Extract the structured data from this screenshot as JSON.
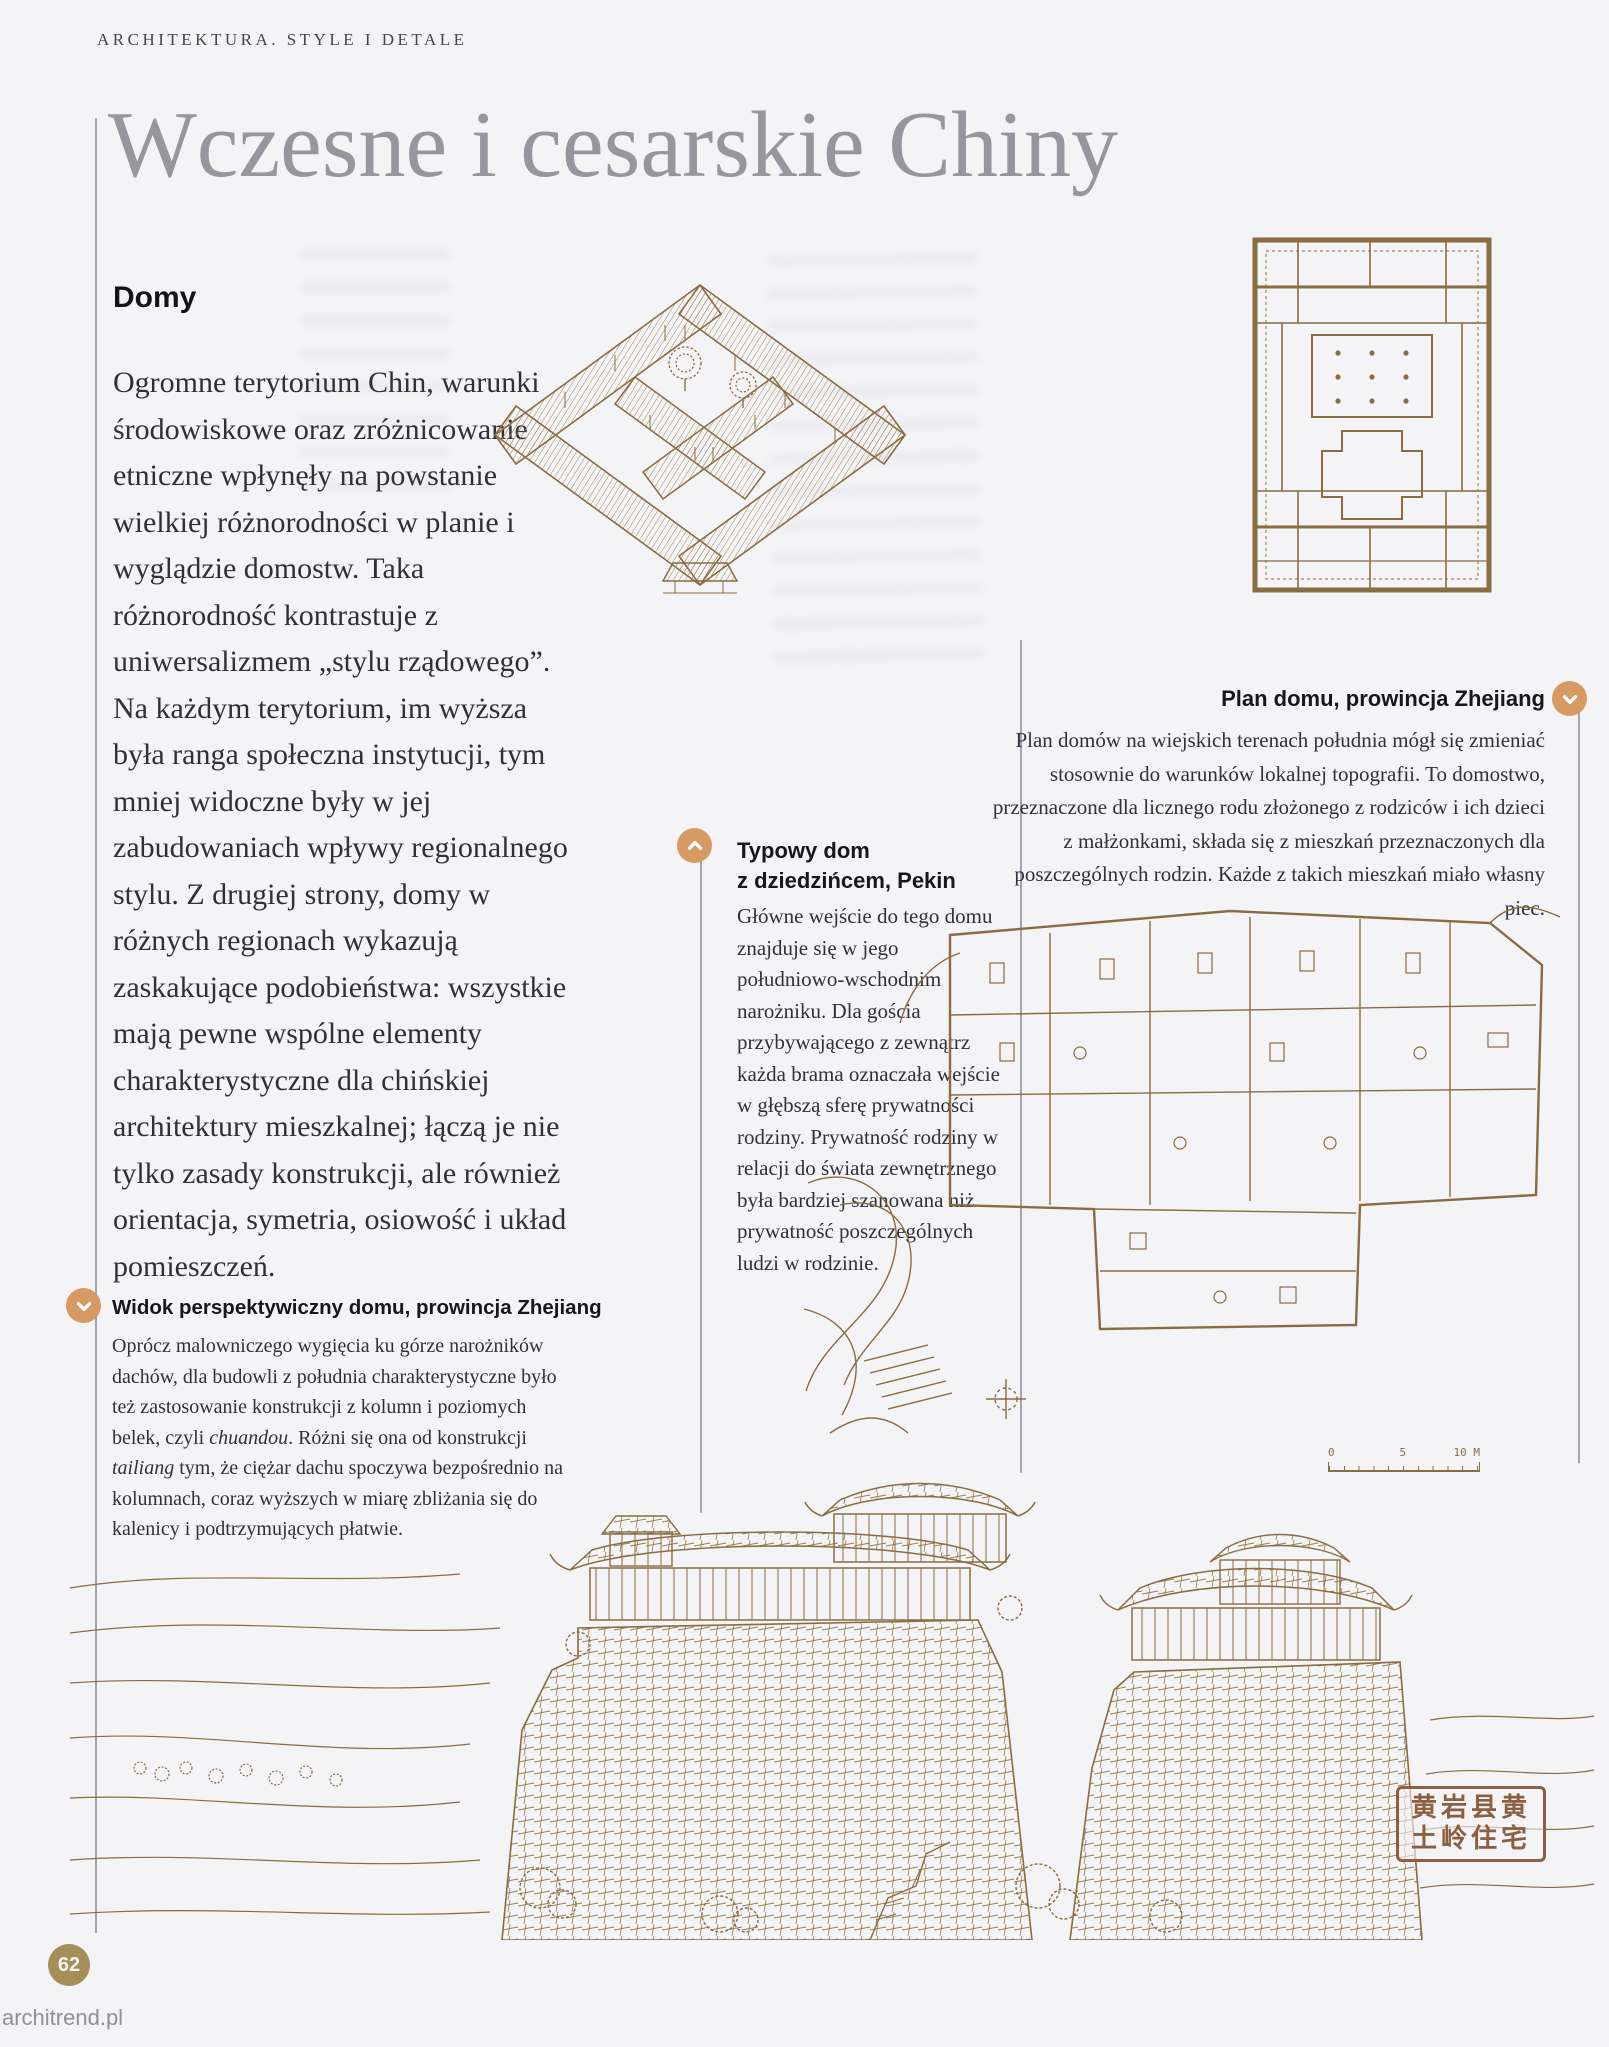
{
  "page": {
    "header": "ARCHITEKTURA. STYLE I DETALE",
    "title": "Wczesne i cesarskie Chiny",
    "page_number": "62",
    "watermark": "architrend.pl"
  },
  "intro": {
    "heading": "Domy",
    "body": "Ogromne terytorium Chin, warunki środowiskowe oraz zróżnicowanie etniczne wpłynęły na powstanie wielkiej różnorodności w planie i wyglądzie domostw. Taka różnorodność kontrastuje z uniwersalizmem „stylu rządowego”. Na każdym terytorium, im wyższa była ranga społeczna instytucji, tym mniej widoczne były w jej zabudowaniach wpływy regionalnego stylu. Z drugiej strony, domy w różnych regionach wykazują zaskakujące podobieństwa: wszystkie mają pewne wspólne elementy charakterystyczne dla chińskiej architektury mieszkalnej; łączą je nie tylko zasady konstrukcji, ale również orientacja, symetria, osiowość i układ pomieszczeń."
  },
  "caption_perspective": {
    "title": "Widok perspektywiczny domu, prowincja Zhejiang",
    "body_1": "Oprócz malowniczego wygięcia ku górze narożników dachów, dla budowli z południa charakterystyczne było też zastosowanie konstrukcji z kolumn i poziomych belek, czyli ",
    "term_1": "chuandou",
    "body_2": ". Różni się ona od konstrukcji ",
    "term_2": "tailiang",
    "body_3": " tym, że ciężar dachu spoczywa bezpośrednio na kolumnach, coraz wyższych w miarę zbliżania się do kalenicy i podtrzymujących płatwie."
  },
  "caption_courtyard": {
    "title_line1": "Typowy dom",
    "title_line2": "z dziedzińcem, Pekin",
    "body": "Główne wejście do tego domu znajduje się w jego południowo-wschodnim narożniku. Dla gościa przybywającego z zewnątrz każda brama oznaczała wejście w głębszą sferę prywatności rodziny. Prywatność rodziny w relacji do świata zewnętrznego była bardziej szanowana niż prywatność poszczególnych ludzi w rodzinie."
  },
  "caption_plan": {
    "title": "Plan domu, prowincja Zhejiang",
    "body": "Plan domów na wiejskich terenach południa mógł się zmieniać stosownie do warunków lokalnej topografii. To domostwo, przeznaczone dla licznego rodu złożonego z rodziców i ich dzieci z małżonkami, składa się z mieszkań przeznaczonych dla poszczególnych rodzin. Każde z takich mieszkań miało własny piec."
  },
  "scale_bar": {
    "zero": "0",
    "five": "5",
    "ten": "10 M"
  },
  "seal": {
    "row1": "黄岩县黄",
    "row2": "土岭住宅"
  },
  "colors": {
    "accent_tan": "#d79a62",
    "sepia_ink": "#8a6c42",
    "page_badge": "#a58e57",
    "title_gray": "#97969e"
  }
}
